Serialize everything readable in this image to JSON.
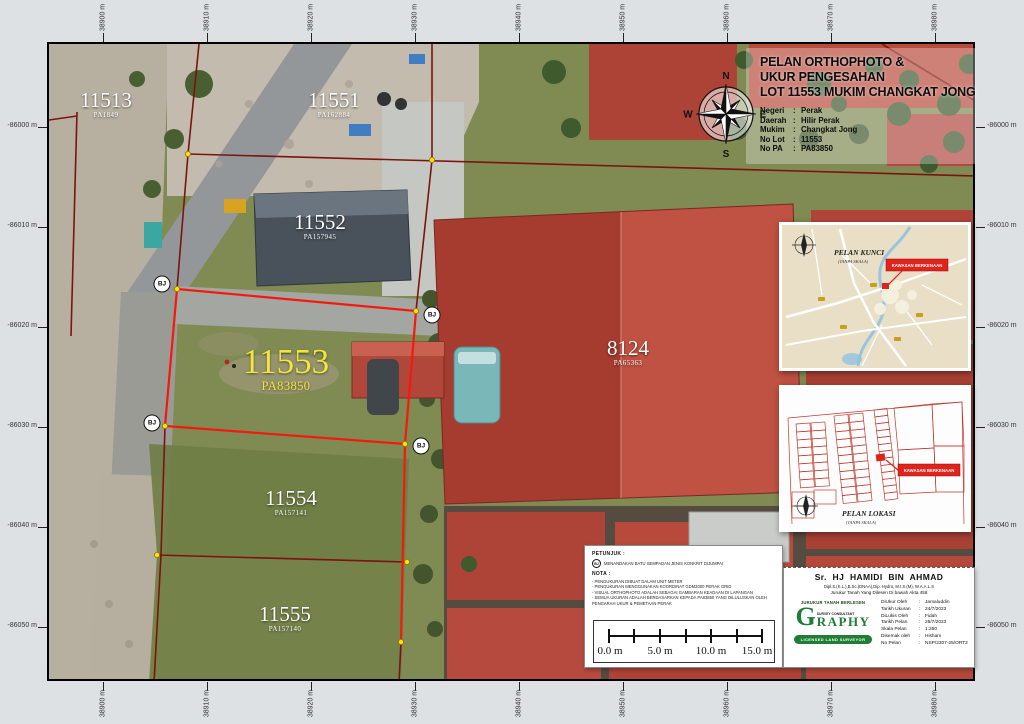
{
  "punct": {
    "colon": ":"
  },
  "title_block": {
    "title_lines": [
      "PELAN ORTHOPHOTO &",
      "UKUR PENGESAHAN",
      "LOT 11553 MUKIM CHANGKAT JONG"
    ],
    "details": [
      {
        "label": "Negeri",
        "value": "Perak"
      },
      {
        "label": "Daerah",
        "value": "Hilir Perak"
      },
      {
        "label": "Mukim",
        "value": "Changkat Jong"
      },
      {
        "label": "No Lot",
        "value": "11553"
      },
      {
        "label": "No PA",
        "value": "PA83850"
      }
    ]
  },
  "compass": {
    "n": "N",
    "e": "E",
    "s": "S",
    "w": "W"
  },
  "coords": {
    "x": [
      "38900 m",
      "38910 m",
      "38920 m",
      "38930 m",
      "38940 m",
      "38950 m",
      "38960 m",
      "38970 m",
      "38980 m"
    ],
    "y": [
      "-86000 m",
      "-86010 m",
      "-86020 m",
      "-86030 m",
      "-86040 m",
      "-86050 m"
    ]
  },
  "bj": "BJ",
  "lots": [
    {
      "num": "11513",
      "pa": "PA1849"
    },
    {
      "num": "11551",
      "pa": "PA162884"
    },
    {
      "num": "11552",
      "pa": "PA157945"
    },
    {
      "num": "11553",
      "pa": "PA83850"
    },
    {
      "num": "8124",
      "pa": "PA65363"
    },
    {
      "num": "11554",
      "pa": "PA157141"
    },
    {
      "num": "11555",
      "pa": "PA157140"
    }
  ],
  "insets": [
    {
      "title": "PELAN KUNCI",
      "subtitle": "(TANPA SKALA)",
      "marker_label": "KAWASAN BERKENAAN"
    },
    {
      "title": "PELAN LOKASI",
      "subtitle": "(TANPA SKALA)",
      "marker_label": "KAWASAN BERKENAAN"
    }
  ],
  "legend": {
    "petunjuk_heading": "PETUNJUK :",
    "bj_symbol": "BJ",
    "bj_text": "MENANDAKAN BATU SEMPADAN JENIS KONKRIT DIJUMPAI",
    "nota_heading": "NOTA :",
    "nota_lines": [
      "- PENGUKURAN DIBUAT DALAM UNIT METER",
      "- PENGUKURAN MENGGUNAKAN KOORDINAT GDM2000 PERAK GRID",
      "- VISUAL ORTHOPHOTO ADALAH SEBAGAI GAMBARAN KEADAAN DI LAPANGAN",
      "- SEMUA UKURAN ADALAH BERDASARKAN KEPADA PA83850 YANG DILULUSKAN OLEH",
      "  PENGARAH UKUR & PEMETAAN PERAK"
    ]
  },
  "scalebar": {
    "labels": [
      "0.0 m",
      "5.0 m",
      "10.0 m",
      "15.0 m"
    ]
  },
  "surveyor": {
    "name": "Sr. HJ HAMIDI BIN AHMAD",
    "credentials": "Dipl.S.(K.L.),B.Sc.(DNAA),Dip. Hydro, M.I.S.(M), W.A.A.L.S",
    "license_line": "Jurukur Tanah Yang Dilesen Di bawah Akta 458",
    "firm_heading": "JURUKUR TANAH BERLESEN",
    "logo_g": "G",
    "logo_rest": "RAPHY",
    "logo_sub": "SURVEY CONSULTANT",
    "logo_badge": "LICENSED LAND SURVEYOR",
    "rows": [
      {
        "label": "DiUkur Oleh",
        "value": "Jamaluddin"
      },
      {
        "label": "Tarikh Ukuran",
        "value": "24/7/2023"
      },
      {
        "label": "DiLukis Oleh",
        "value": "Fidah"
      },
      {
        "label": "Tarikh Pelan",
        "value": "25/7/2023"
      },
      {
        "label": "Skala Pelan",
        "value": "1:250"
      },
      {
        "label": "Disemak oleh",
        "value": "Hisham"
      },
      {
        "label": "No Pelan",
        "value": "NSP/2307-25/ORT2"
      }
    ]
  },
  "colors": {
    "boundary_red": "#f5190d",
    "cadastral_maroon": "#7d130e",
    "marker_yellow": "#ffe20a",
    "logo_green": "#1f7d36"
  }
}
